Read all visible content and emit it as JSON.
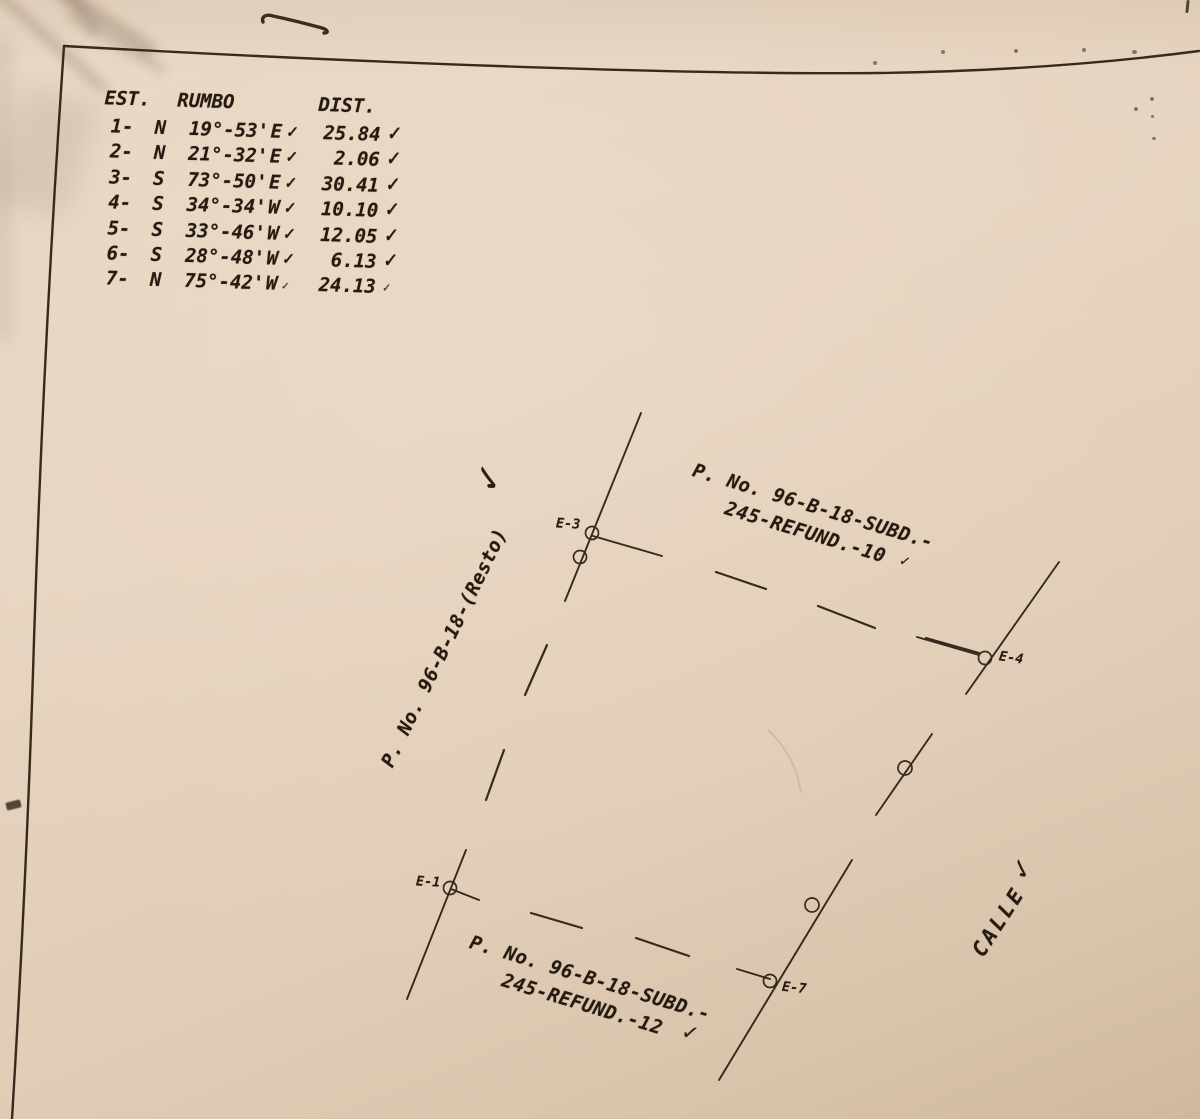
{
  "colors": {
    "paper": "#e4d1bb",
    "ink": "#241a10"
  },
  "glyphs": {
    "check": "✓"
  },
  "table": {
    "headers": {
      "est": "EST.",
      "rumbo": "RUMBO",
      "dist": "DIST."
    },
    "rows": [
      {
        "est": "1-",
        "rumbo": "N  19°-53'",
        "ew": "E",
        "dist": "25.84"
      },
      {
        "est": "2-",
        "rumbo": "N  21°-32'",
        "ew": "E",
        "dist": "2.06"
      },
      {
        "est": "3-",
        "rumbo": "S  73°-50'",
        "ew": "E",
        "dist": "30.41"
      },
      {
        "est": "4-",
        "rumbo": "S  34°-34'",
        "ew": "W",
        "dist": "10.10"
      },
      {
        "est": "5-",
        "rumbo": "S  33°-46'",
        "ew": "W",
        "dist": "12.05"
      },
      {
        "est": "6-",
        "rumbo": "S  28°-48'",
        "ew": "W",
        "dist": "6.13"
      },
      {
        "est": "7-",
        "rumbo": "N  75°-42'",
        "ew": "W",
        "dist": "24.13"
      }
    ]
  },
  "diagram": {
    "labels": {
      "resto": "P. No. 96-B-18-(Resto)",
      "subd10_line1": "P. No. 96-B-18-SUBD.-",
      "subd10_line2": "245-REFUND.-10",
      "subd12_line1": "P. No. 96-B-18-SUBD.-",
      "subd12_line2": "245-REFUND.-12",
      "street": "CALLE"
    },
    "points": {
      "e1": "E-1",
      "e3": "E-3",
      "e4": "E-4",
      "e7": "E-7"
    }
  }
}
